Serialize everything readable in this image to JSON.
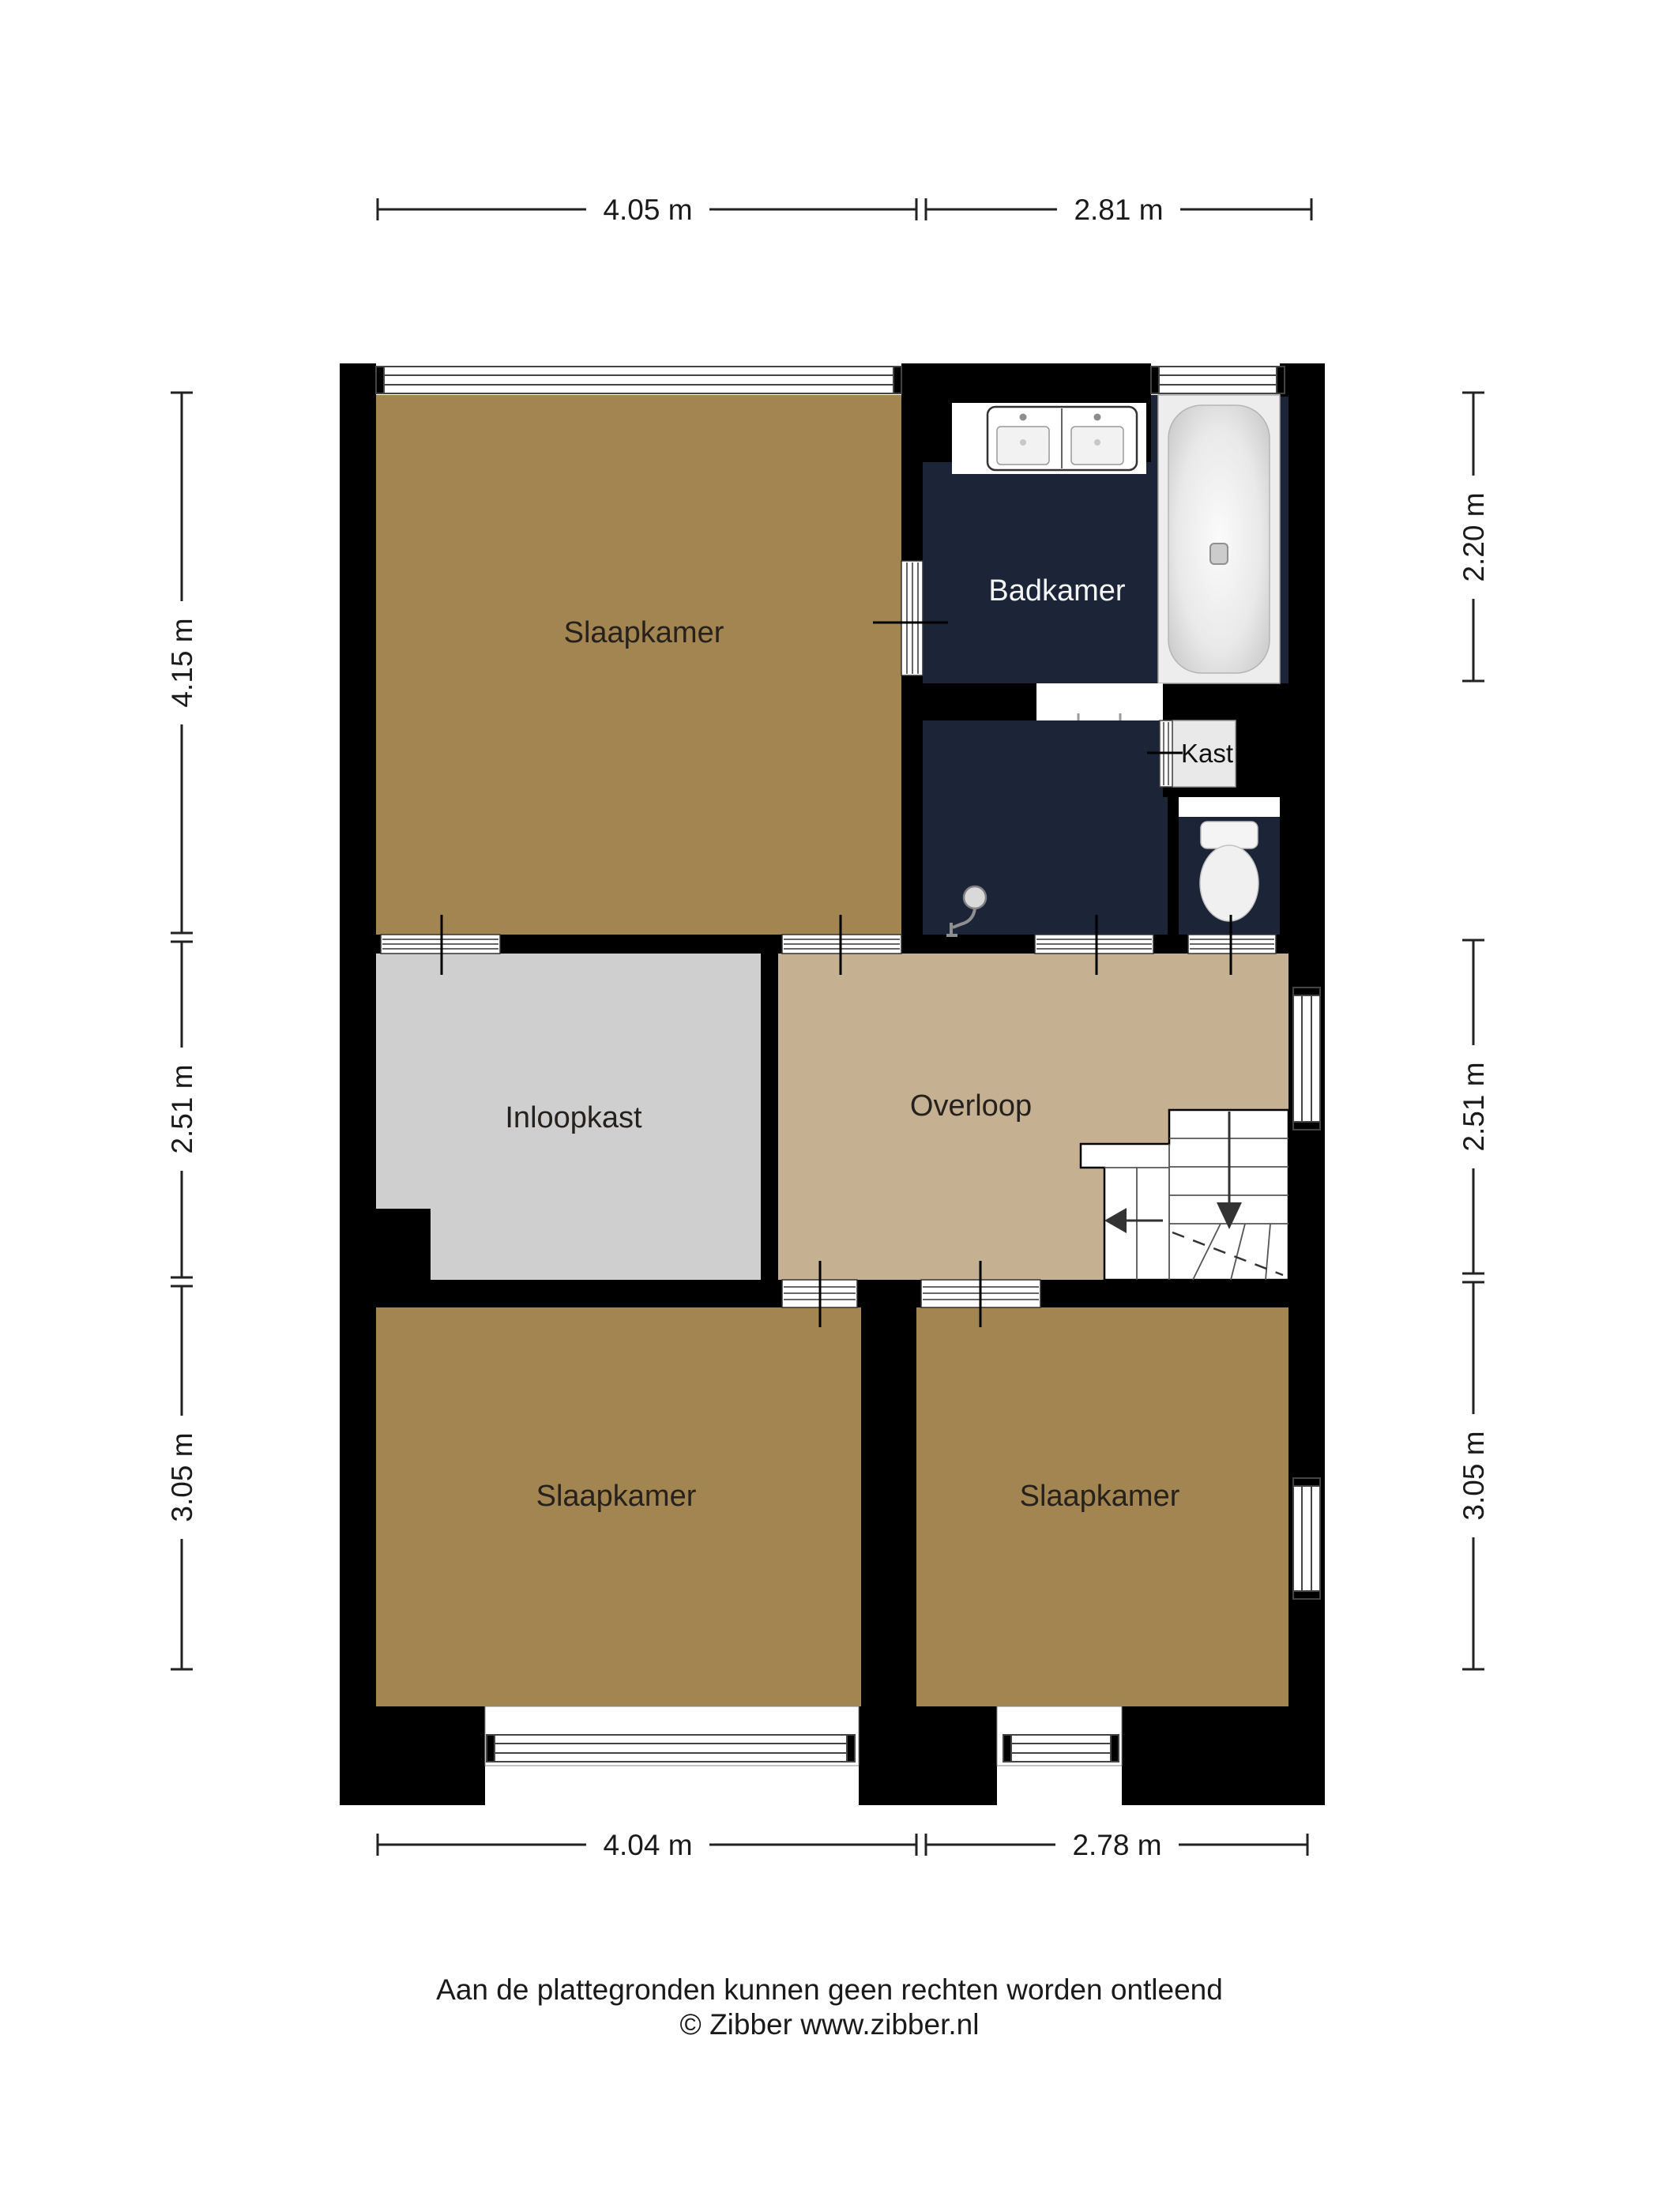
{
  "rooms": {
    "bedroom_tl": {
      "label": "Slaapkamer"
    },
    "bathroom": {
      "label": "Badkamer"
    },
    "closet": {
      "label": "Kast"
    },
    "walk_in_closet": {
      "label": "Inloopkast"
    },
    "landing": {
      "label": "Overloop"
    },
    "bedroom_bl": {
      "label": "Slaapkamer"
    },
    "bedroom_br": {
      "label": "Slaapkamer"
    }
  },
  "dimensions": {
    "top": [
      {
        "label": "4.05 m"
      },
      {
        "label": "2.81 m"
      }
    ],
    "bottom": [
      {
        "label": "4.04 m"
      },
      {
        "label": "2.78 m"
      }
    ],
    "left": [
      {
        "label": "4.15 m"
      },
      {
        "label": "2.51 m"
      },
      {
        "label": "3.05 m"
      }
    ],
    "right": [
      {
        "label": "2.20 m"
      },
      {
        "label": "2.51 m"
      },
      {
        "label": "3.05 m"
      }
    ]
  },
  "footer": {
    "disclaimer": "Aan de plattegronden kunnen geen rechten worden ontleend",
    "credit": "© Zibber www.zibber.nl"
  },
  "colors": {
    "wall": "#000000",
    "bedroom_floor": "#A28550",
    "landing_floor": "#C5B091",
    "bathroom_floor": "#1B2537",
    "walk_in_closet_floor": "#CFCFCF",
    "closet_box": "#E9E9E9"
  }
}
